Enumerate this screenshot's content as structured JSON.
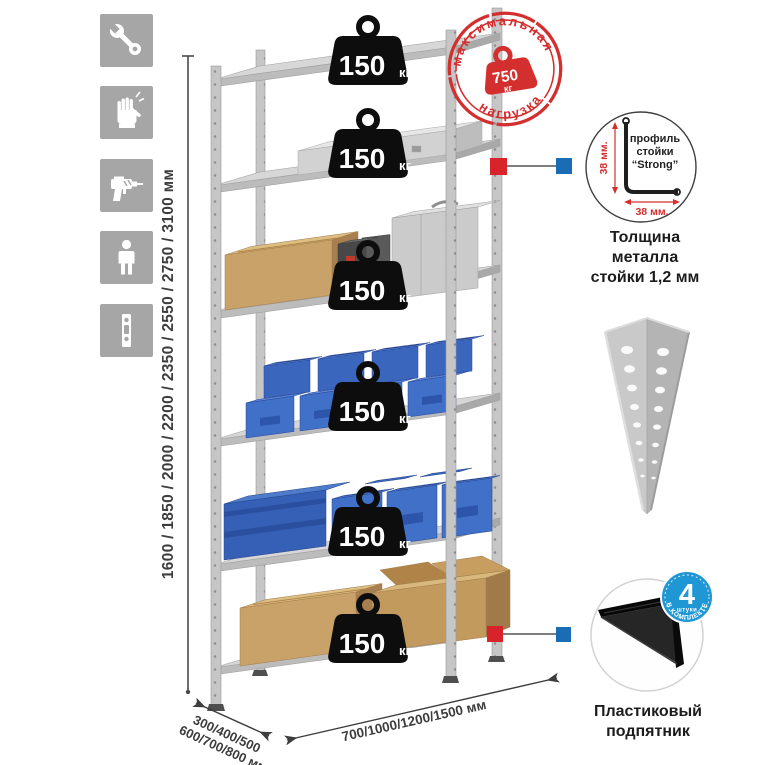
{
  "colors": {
    "accent_red": "#d8232a",
    "marker_blue": "#1a6cb5",
    "badge_blue": "#1f97d4",
    "bin_blue": "#3f6fc7",
    "metal_gray": "#c9c9c9",
    "cardboard": "#c8a268",
    "icon_tile_gray": "#a6a6a6"
  },
  "left_icons": [
    {
      "name": "wrench-icon"
    },
    {
      "name": "gloves-icon"
    },
    {
      "name": "drill-icon"
    },
    {
      "name": "person-icon"
    },
    {
      "name": "post-profile-icon"
    }
  ],
  "dimensions": {
    "height": {
      "label": "1600 / 1850 / 2000 / 2200 / 2350 / 2550 / 2750 / 3100 мм"
    },
    "depth": {
      "line1": "300/400/500",
      "line2": "600/700/800 мм"
    },
    "width": {
      "label": "700/1000/1200/1500 мм"
    }
  },
  "weights": [
    {
      "value": "150",
      "unit": "кг"
    },
    {
      "value": "150",
      "unit": "кг"
    },
    {
      "value": "150",
      "unit": "кг"
    },
    {
      "value": "150",
      "unit": "кг"
    },
    {
      "value": "150",
      "unit": "кг"
    },
    {
      "value": "150",
      "unit": "кг"
    }
  ],
  "stamp": {
    "arc_top": "максимальная",
    "arc_bottom": "нагрузка",
    "value": "750",
    "unit": "кг"
  },
  "profile": {
    "label1": "профиль",
    "label2": "стойки",
    "label3": "“Strong”",
    "dim_vertical": "38 мм.",
    "dim_horizontal": "38 мм.",
    "caption_line1": "Толщина металла",
    "caption_line2": "стойки 1,2 мм"
  },
  "foot": {
    "badge_value": "4",
    "badge_sub": "штуки",
    "badge_arc": "в комплекте",
    "caption_line1": "Пластиковый",
    "caption_line2": "подпятник"
  }
}
